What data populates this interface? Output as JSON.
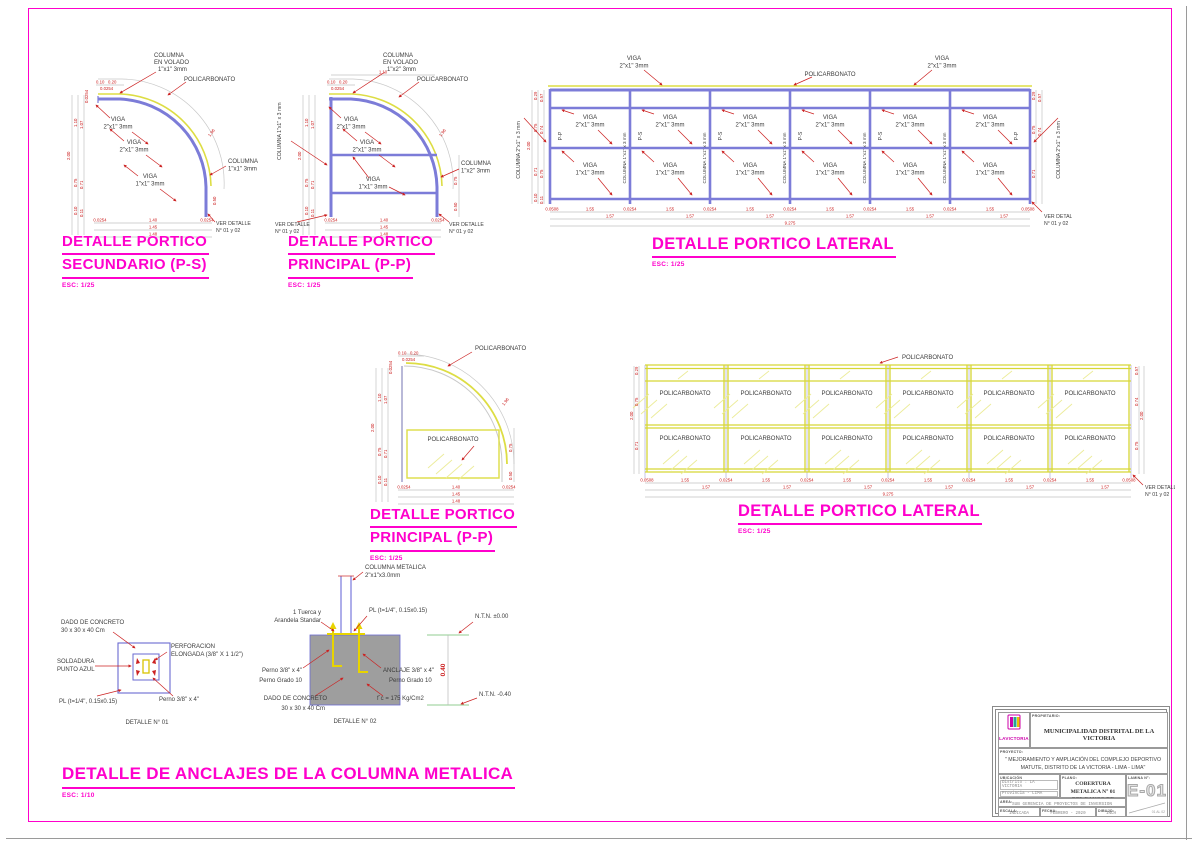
{
  "sheet": {
    "border_color": "#ff00cc"
  },
  "labels": {
    "policarbonato": "POLICARBONATO",
    "viga": "VIGA",
    "s2x1": "2\"x1\" 3mm",
    "s1x1": "1\"x1\" 3mm",
    "s1x2": "1\"x2\" 3mm",
    "columna": "COLUMNA",
    "en_volado": "EN VOLADO",
    "columna_1x1x3": "COLUMNA 1\"x1\" x 3 mm",
    "columna_2x1x3": "COLUMNA 2\"x1\" x 3 mm",
    "ver_detalle1": "VER DETALLE",
    "ver_detalle2": "N° 01 y 02",
    "pp": "P-P",
    "ps": "P-S"
  },
  "titles": {
    "detalle_portico": "DETALLE PORTICO",
    "secundario2": "SECUNDARIO (P-S)",
    "principal2": "PRINCIPAL (P-P)",
    "lateral": "DETALLE PORTICO LATERAL",
    "anclajes": "DETALLE DE ANCLAJES DE LA COLUMNA METALICA",
    "esc125": "ESC: 1/25",
    "esc110": "ESC: 1/10"
  },
  "dims": {
    "d0254": "0.0254",
    "d0508": "0.0508",
    "d155": "1.55",
    "d157": "1.57",
    "d9275": "9.275",
    "d200": "2.00",
    "d110": "1.10",
    "d107": "1.07",
    "d075": "0.75",
    "d074": "0.74",
    "d071": "0.71",
    "d057": "0.57",
    "d029": "0.29",
    "d011": "0.11",
    "d010": "0.10",
    "d020": "0.20",
    "d050": "0.50",
    "d140": "1.40",
    "d145": "1.45",
    "d148": "1.48",
    "d196": "1.96",
    "d040": "0.40"
  },
  "anchor1": {
    "dado1": "DADO DE CONCRETO",
    "dado2": "30 x 30 x 40 Cm",
    "perf1": "PERFORACION",
    "perf2": "ELONGADA (3/8\" X 1 1/2\")",
    "sold1": "SOLDADURA",
    "sold2": "PUNTO AZUL",
    "pl": "PL (t=1/4\", 0.15x0.15)",
    "perno": "Perno 3/8\" x 4\"",
    "caption": "DETALLE N° 01"
  },
  "anchor2": {
    "colmet1": "COLUMNA METALICA",
    "colmet2": "2\"x1\"x3.0mm",
    "tuerca1": "1 Tuerca y",
    "tuerca2": "Arandela Standar",
    "pl": "PL (t=1/4\", 0.15x0.15)",
    "ntn0": "N.T.N.  ±0.00",
    "ntn40": "N.T.N.  -0.40",
    "perno1": "Perno 3/8\" x 4\"",
    "perno2": "Perno Grado 10",
    "anclaje1": "ANCLAJE 3/8\" x 4\"",
    "anclaje2": "Perno Grado 10",
    "dado1": "DADO DE CONCRETO",
    "dado2": "30 x 30 x 40 Cm",
    "fc": "f´c = 175 Kg/Cm2",
    "caption": "DETALLE N° 02"
  },
  "titleblock": {
    "logo": "LAVICTORIA",
    "propietario_label": "PROPIETARIO:",
    "propietario": "MUNICIPALIDAD DISTRITAL DE LA VICTORIA",
    "proyecto_label": "PROYECTO:",
    "proyecto1": "\" MEJORAMIENTO Y AMPLIACIÓN DEL COMPLEJO DEPORTIVO",
    "proyecto2": "MATUTE, DISTRITO DE LA VICTORIA - LIMA - LIMA\"",
    "ubicacion_label": "UBICACIÓN",
    "distrito": "Distrito : LA VICTORIA",
    "provincia": "Provincia  - LIMA",
    "departamento": "Departamento  - LIMA",
    "plano_label": "PLANO:",
    "plano1": "COBERTURA METALICA N° 01",
    "plano2": "DEL BANCO DE RESERVA",
    "lamina_label": "LAMINA N°:",
    "lamina": "E-01",
    "area_label": "AREA:",
    "area": "SUB GERENCIA DE PROYECTOS DE INVERSION",
    "escala_label": "ESCALA:",
    "escala": "INDICADA",
    "fecha_label": "FECHA:",
    "fecha": "FEBRERO - 2020",
    "dibujo_label": "DIBUJO:",
    "dibujo": "INCH",
    "hoja": "01 AL 02"
  }
}
